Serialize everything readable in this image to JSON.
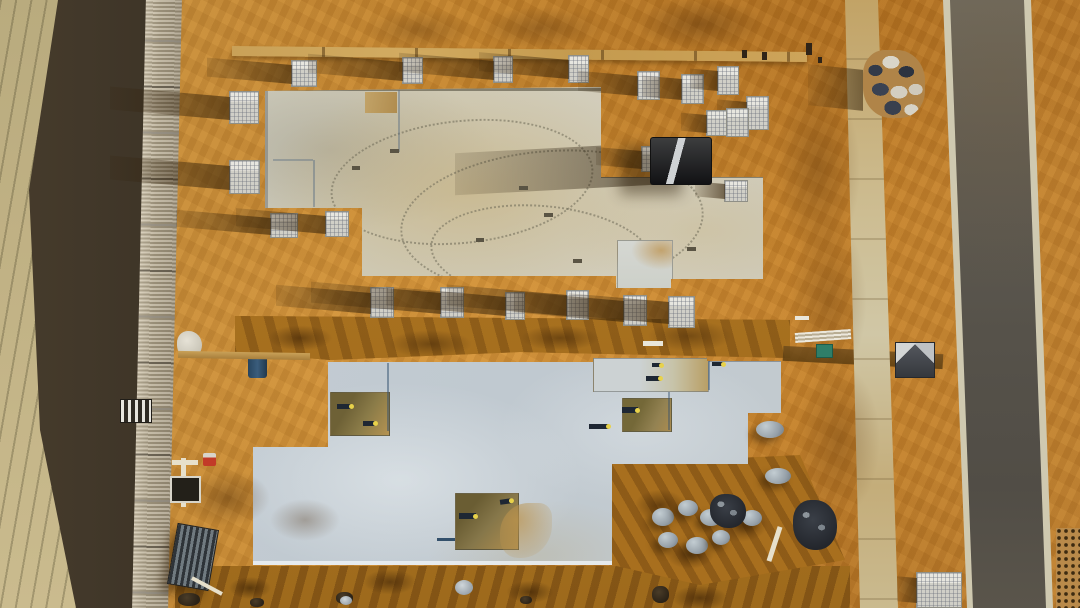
{
  "meta": {
    "title": "Aerial drone view of a construction site: two concrete slab foundations on orange sand, brick pallets, a telehandler, a footpath and an asphalt road",
    "type": "aerial-photograph"
  },
  "palette": {
    "sand": "#c6862e",
    "sand_shadow": "#7c5112",
    "pale_sand": "#b9ab7e",
    "top_slab": "#cbc7b6",
    "bottom_slab": "#c2cbd2",
    "road_asphalt": "#56524a",
    "curb": "#cfc9b0",
    "footpath": "#cdbd92",
    "building_shadow": "#2c2720",
    "roof_metal": "#b3a78d",
    "pallet": "#d8d7cf",
    "brick_navy": "#323a49",
    "pipe_cap_yellow": "#e8d24a"
  },
  "scene": {
    "objects": [
      {
        "name": "brick-pallet",
        "t": "pallet",
        "x": 291,
        "y": 60,
        "w": 24,
        "h": 25,
        "s": 85
      },
      {
        "name": "brick-pallet",
        "t": "pallet",
        "x": 402,
        "y": 57,
        "w": 19,
        "h": 25,
        "s": 95
      },
      {
        "name": "brick-pallet",
        "t": "pallet",
        "x": 493,
        "y": 56,
        "w": 18,
        "h": 25,
        "s": 95
      },
      {
        "name": "brick-pallet",
        "t": "pallet",
        "x": 568,
        "y": 55,
        "w": 19,
        "h": 26,
        "s": 90
      },
      {
        "name": "brick-pallet",
        "t": "pallet",
        "x": 637,
        "y": 71,
        "w": 21,
        "h": 27,
        "s": 60
      },
      {
        "name": "brick-pallet",
        "t": "pallet",
        "x": 681,
        "y": 74,
        "w": 21,
        "h": 28,
        "s": 40
      },
      {
        "name": "brick-pallet",
        "t": "pallet",
        "x": 717,
        "y": 66,
        "w": 20,
        "h": 27,
        "s": 28
      },
      {
        "name": "brick-pallet",
        "t": "pallet",
        "x": 746,
        "y": 96,
        "w": 21,
        "h": 32,
        "s": 30
      },
      {
        "name": "brick-pallet",
        "t": "pallet",
        "x": 706,
        "y": 110,
        "w": 19,
        "h": 24,
        "s": 26
      },
      {
        "name": "brick-pallet",
        "t": "pallet",
        "x": 726,
        "y": 108,
        "w": 21,
        "h": 27,
        "s": 0
      },
      {
        "name": "brick-pallet",
        "t": "pallet",
        "x": 641,
        "y": 146,
        "w": 20,
        "h": 24,
        "s": 46
      },
      {
        "name": "brick-pallet",
        "t": "pallet",
        "x": 724,
        "y": 180,
        "w": 22,
        "h": 20,
        "s": 30
      },
      {
        "name": "brick-pallet",
        "t": "pallet",
        "x": 229,
        "y": 91,
        "w": 28,
        "h": 31,
        "s": 120
      },
      {
        "name": "brick-pallet",
        "t": "pallet",
        "x": 229,
        "y": 160,
        "w": 29,
        "h": 32,
        "s": 120
      },
      {
        "name": "brick-pallet",
        "t": "pallet",
        "x": 270,
        "y": 213,
        "w": 26,
        "h": 23,
        "s": 95
      },
      {
        "name": "brick-pallet",
        "t": "pallet",
        "x": 325,
        "y": 211,
        "w": 22,
        "h": 24,
        "s": 90
      },
      {
        "name": "brick-pallet",
        "t": "pallet",
        "x": 370,
        "y": 287,
        "w": 22,
        "h": 29,
        "s": 95
      },
      {
        "name": "brick-pallet",
        "t": "pallet",
        "x": 440,
        "y": 287,
        "w": 22,
        "h": 29,
        "s": 130
      },
      {
        "name": "brick-pallet",
        "t": "pallet",
        "x": 505,
        "y": 292,
        "w": 18,
        "h": 26,
        "s": 120
      },
      {
        "name": "brick-pallet",
        "t": "pallet",
        "x": 566,
        "y": 290,
        "w": 21,
        "h": 28,
        "s": 120
      },
      {
        "name": "brick-pallet",
        "t": "pallet",
        "x": 623,
        "y": 295,
        "w": 22,
        "h": 29,
        "s": 110
      },
      {
        "name": "brick-pallet",
        "t": "pallet",
        "x": 668,
        "y": 296,
        "w": 25,
        "h": 30,
        "s": 100
      },
      {
        "name": "brick-pallet",
        "t": "pallet",
        "x": 916,
        "y": 572,
        "w": 44,
        "h": 34,
        "s": 20
      },
      {
        "name": "telehandler",
        "t": "forklift",
        "x": 650,
        "y": 137,
        "w": 62,
        "h": 48
      },
      {
        "name": "brick-rubble-pile",
        "t": "brickpile",
        "x": 863,
        "y": 50,
        "w": 62,
        "h": 68,
        "s": 55
      },
      {
        "name": "small-shelter",
        "t": "tent",
        "x": 895,
        "y": 342,
        "w": 38,
        "h": 34
      },
      {
        "name": "green-crate",
        "t": "green-box",
        "x": 816,
        "y": 344,
        "w": 15,
        "h": 12
      },
      {
        "name": "pvc-pipe-bundle",
        "t": "pipes-bundle",
        "x": 795,
        "y": 331,
        "w": 56,
        "h": 10,
        "r": -4
      },
      {
        "name": "blue-barrel",
        "t": "blue-barrel",
        "x": 248,
        "y": 353,
        "w": 19,
        "h": 25
      },
      {
        "name": "white-bag",
        "t": "white-bag",
        "x": 177,
        "y": 331,
        "w": 25,
        "h": 27
      },
      {
        "name": "red-marker",
        "t": "red-marker",
        "x": 203,
        "y": 453,
        "w": 13,
        "h": 13
      },
      {
        "name": "standpipe-vertical",
        "t": "pipe-v",
        "x": 181,
        "y": 458,
        "w": 5,
        "h": 49
      },
      {
        "name": "standpipe-horizontal",
        "t": "pipe-h",
        "x": 172,
        "y": 460,
        "w": 26,
        "h": 5
      },
      {
        "name": "dark-panel",
        "t": "dark-panel",
        "x": 170,
        "y": 476,
        "w": 27,
        "h": 23
      },
      {
        "name": "corrugated-sheet-stack",
        "t": "corrugated-stack",
        "x": 172,
        "y": 526,
        "w": 40,
        "h": 60,
        "r": 10
      },
      {
        "name": "white-stick",
        "t": "white-stick",
        "x": 190,
        "y": 584,
        "w": 34,
        "h": 4,
        "r": 28
      },
      {
        "name": "stick",
        "t": "stick",
        "x": 772,
        "y": 526,
        "w": 5,
        "h": 36,
        "r": 18
      },
      {
        "name": "timber-plank",
        "t": "plank",
        "x": 178,
        "y": 352,
        "w": 132,
        "h": 7,
        "r": 1
      },
      {
        "name": "rock-mound",
        "t": "rock",
        "x": 652,
        "y": 508,
        "w": 22,
        "h": 18
      },
      {
        "name": "rock-mound",
        "t": "rock",
        "x": 678,
        "y": 500,
        "w": 20,
        "h": 16
      },
      {
        "name": "rock-mound",
        "t": "rock",
        "x": 700,
        "y": 509,
        "w": 22,
        "h": 17
      },
      {
        "name": "rock-mound",
        "t": "rock",
        "x": 724,
        "y": 501,
        "w": 18,
        "h": 15
      },
      {
        "name": "rock-mound",
        "t": "rock",
        "x": 742,
        "y": 510,
        "w": 20,
        "h": 16
      },
      {
        "name": "rock-mound",
        "t": "rock",
        "x": 658,
        "y": 532,
        "w": 20,
        "h": 16
      },
      {
        "name": "rock-mound",
        "t": "rock",
        "x": 686,
        "y": 537,
        "w": 22,
        "h": 17
      },
      {
        "name": "rock-mound",
        "t": "rock",
        "x": 712,
        "y": 530,
        "w": 18,
        "h": 15
      },
      {
        "name": "rock-mound",
        "t": "rock",
        "x": 756,
        "y": 421,
        "w": 28,
        "h": 17
      },
      {
        "name": "rock-mound",
        "t": "rock",
        "x": 765,
        "y": 468,
        "w": 26,
        "h": 16
      },
      {
        "name": "dark-rubble",
        "t": "rubble-dark",
        "x": 710,
        "y": 494,
        "w": 36,
        "h": 34
      },
      {
        "name": "dark-rubble",
        "t": "rubble-dark",
        "x": 793,
        "y": 500,
        "w": 44,
        "h": 50
      },
      {
        "name": "debris",
        "t": "debris-dark",
        "x": 336,
        "y": 592,
        "w": 17,
        "h": 12
      },
      {
        "name": "debris",
        "t": "debris-dark",
        "x": 250,
        "y": 598,
        "w": 14,
        "h": 9
      },
      {
        "name": "debris",
        "t": "debris-dark",
        "x": 178,
        "y": 593,
        "w": 22,
        "h": 13
      },
      {
        "name": "debris",
        "t": "debris-dark",
        "x": 520,
        "y": 596,
        "w": 12,
        "h": 8
      },
      {
        "name": "debris",
        "t": "debris-dark",
        "x": 652,
        "y": 586,
        "w": 17,
        "h": 17
      },
      {
        "name": "stone",
        "t": "stone",
        "x": 455,
        "y": 580,
        "w": 18,
        "h": 15
      },
      {
        "name": "stone",
        "t": "stone",
        "x": 340,
        "y": 596,
        "w": 12,
        "h": 9
      },
      {
        "name": "plumbing-pipe",
        "t": "pipe",
        "x": 337,
        "y": 404,
        "w": 15,
        "h": 5
      },
      {
        "name": "plumbing-pipe",
        "t": "pipe",
        "x": 363,
        "y": 421,
        "w": 13,
        "h": 5
      },
      {
        "name": "plumbing-pipe",
        "t": "pipe",
        "x": 459,
        "y": 513,
        "w": 17,
        "h": 6
      },
      {
        "name": "plumbing-pipe",
        "t": "pipe",
        "x": 500,
        "y": 499,
        "w": 12,
        "h": 5,
        "r": -8
      },
      {
        "name": "plumbing-pipe",
        "t": "pipe",
        "x": 646,
        "y": 376,
        "w": 15,
        "h": 5
      },
      {
        "name": "plumbing-pipe",
        "t": "pipe",
        "x": 652,
        "y": 363,
        "w": 10,
        "h": 4
      },
      {
        "name": "plumbing-pipe",
        "t": "pipe",
        "x": 622,
        "y": 407,
        "w": 16,
        "h": 6
      },
      {
        "name": "plumbing-pipe",
        "t": "pipe",
        "x": 589,
        "y": 424,
        "w": 20,
        "h": 5
      },
      {
        "name": "plumbing-pipe",
        "t": "pipe",
        "x": 712,
        "y": 362,
        "w": 12,
        "h": 4
      },
      {
        "name": "slab-mark",
        "t": "mark",
        "x": 544,
        "y": 213,
        "w": 9,
        "h": 4
      },
      {
        "name": "slab-mark",
        "t": "mark",
        "x": 573,
        "y": 259,
        "w": 9,
        "h": 4
      },
      {
        "name": "slab-mark",
        "t": "mark",
        "x": 687,
        "y": 247,
        "w": 9,
        "h": 4
      },
      {
        "name": "slab-mark",
        "t": "mark",
        "x": 519,
        "y": 186,
        "w": 9,
        "h": 4
      },
      {
        "name": "slab-mark",
        "t": "mark",
        "x": 390,
        "y": 149,
        "w": 9,
        "h": 4
      },
      {
        "name": "slab-mark",
        "t": "mark",
        "x": 476,
        "y": 238,
        "w": 8,
        "h": 4
      },
      {
        "name": "slab-mark",
        "t": "mark",
        "x": 352,
        "y": 166,
        "w": 8,
        "h": 4
      },
      {
        "name": "white-bit",
        "t": "white-bit",
        "x": 643,
        "y": 341,
        "w": 20,
        "h": 5
      },
      {
        "name": "white-bit",
        "t": "white-bit",
        "x": 795,
        "y": 316,
        "w": 14,
        "h": 4
      },
      {
        "name": "survey-peg",
        "t": "peg",
        "x": 742,
        "y": 50,
        "w": 5,
        "h": 8
      },
      {
        "name": "survey-peg",
        "t": "peg",
        "x": 762,
        "y": 52,
        "w": 5,
        "h": 8
      },
      {
        "name": "survey-peg",
        "t": "peg",
        "x": 806,
        "y": 43,
        "w": 6,
        "h": 12
      },
      {
        "name": "survey-peg",
        "t": "peg",
        "x": 818,
        "y": 57,
        "w": 4,
        "h": 6
      }
    ]
  }
}
